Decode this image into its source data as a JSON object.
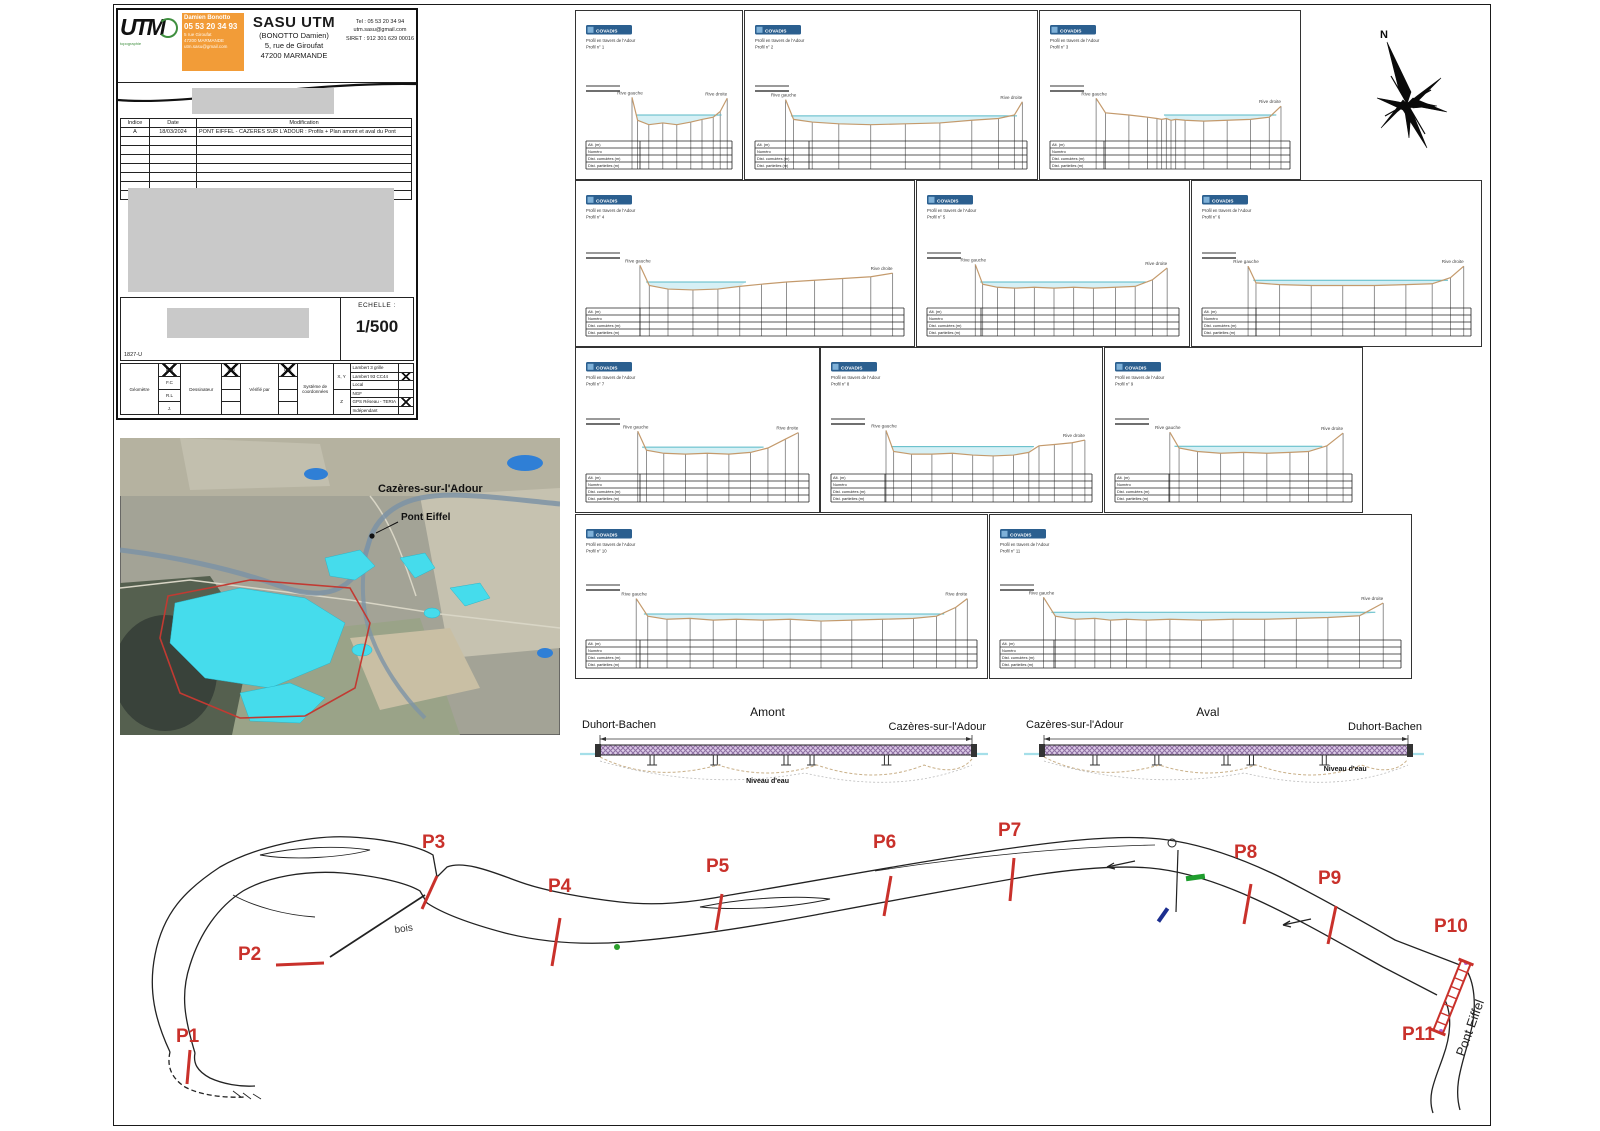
{
  "sheet": {
    "ref": "1827-U",
    "scale_label": "ECHELLE :",
    "scale_value": "1/500",
    "north_label": "N"
  },
  "title_block": {
    "logo_text": "UTM",
    "logo_sub": "topographie",
    "card": {
      "name": "Damien Bonotto",
      "phone": "05 53 20 34 93",
      "line1": "5 rue Giroufat",
      "line2": "47200 MARMANDE",
      "line3": "utm.sasu@gmail.com"
    },
    "company": "SASU UTM",
    "company_sub": "(BONOTTO Damien)",
    "address1": "5, rue de Giroufat",
    "address2": "47200 MARMANDE",
    "tel": "Tel : 05 53 20 34 94",
    "email": "utm.sasu@gmail.com",
    "siret": "SIRET : 912 301 629 00016",
    "revisions": {
      "headers": [
        "Indice",
        "Date",
        "Modification"
      ],
      "rows": [
        [
          "A",
          "18/03/2024",
          "PONT EIFFEL - CAZERES SUR L'ADOUR : Profils + Plan amont et aval du Pont"
        ]
      ],
      "empty_row_count": 7
    }
  },
  "survey_box": {
    "geom_label": "Géomètre",
    "geom_initials": [
      "D.B",
      "F.C",
      "R.L",
      "J."
    ],
    "drafter_label": "Dessinateur",
    "drafter_initial": "D.B",
    "checker_label": "Vérifié par",
    "checker_initial": "D.B",
    "coord_label": "Système de coordonnées",
    "xy_label": "X, Y",
    "z_label": "Z",
    "systems": [
      "Lambert 3 grille",
      "Lambert 93 CC44",
      "Local",
      "NGF",
      "GPS Réseau - TERIA",
      "Indépendant"
    ],
    "checked_systems": [
      1,
      4
    ]
  },
  "map": {
    "town_label": "Cazères-sur-l'Adour",
    "bridge_label": "Pont Eiffel"
  },
  "profiles": {
    "badge": "COVADIS",
    "subtitle": "Profil en travers de l'Adour",
    "left_bank": "Rive gauche",
    "right_bank": "Rive droite",
    "table_rows": [
      "Alt. (m)",
      "Numéro",
      "Dist. cumulées (m)",
      "Dist. partielles (m)"
    ],
    "colors": {
      "terrain": "#c49a6c",
      "water_fill": "#d4eff4",
      "water_line": "#58b9c6",
      "ordinate": "#767676"
    },
    "panels": [
      {
        "id": "P1",
        "label": "Profil n° 1",
        "rect": [
          575,
          10,
          166,
          168
        ],
        "terrain": [
          [
            0.3,
            0.1
          ],
          [
            0.34,
            0.62
          ],
          [
            0.42,
            0.72
          ],
          [
            0.52,
            0.68
          ],
          [
            0.62,
            0.72
          ],
          [
            0.72,
            0.66
          ],
          [
            0.8,
            0.6
          ],
          [
            0.88,
            0.55
          ],
          [
            0.93,
            0.42
          ],
          [
            0.98,
            0.12
          ]
        ],
        "water": {
          "span": [
            0.33,
            0.94
          ],
          "level": 0.5
        }
      },
      {
        "id": "P2",
        "label": "Profil n° 2",
        "rect": [
          744,
          10,
          292,
          168
        ],
        "terrain": [
          [
            0.1,
            0.15
          ],
          [
            0.13,
            0.6
          ],
          [
            0.2,
            0.66
          ],
          [
            0.3,
            0.7
          ],
          [
            0.42,
            0.72
          ],
          [
            0.55,
            0.7
          ],
          [
            0.68,
            0.68
          ],
          [
            0.8,
            0.62
          ],
          [
            0.9,
            0.58
          ],
          [
            0.96,
            0.5
          ],
          [
            0.99,
            0.2
          ]
        ],
        "water": {
          "span": [
            0.12,
            0.97
          ],
          "level": 0.52
        }
      },
      {
        "id": "P3",
        "label": "Profil n° 3",
        "rect": [
          1039,
          10,
          260,
          168
        ],
        "terrain": [
          [
            0.18,
            0.12
          ],
          [
            0.22,
            0.45
          ],
          [
            0.32,
            0.5
          ],
          [
            0.4,
            0.55
          ],
          [
            0.44,
            0.58
          ],
          [
            0.46,
            0.6
          ],
          [
            0.48,
            0.58
          ],
          [
            0.5,
            0.62
          ],
          [
            0.52,
            0.6
          ],
          [
            0.56,
            0.62
          ],
          [
            0.64,
            0.64
          ],
          [
            0.74,
            0.62
          ],
          [
            0.84,
            0.6
          ],
          [
            0.92,
            0.55
          ],
          [
            0.97,
            0.3
          ]
        ],
        "water": {
          "span": [
            0.47,
            0.95
          ],
          "level": 0.5
        }
      },
      {
        "id": "P4",
        "label": "Profil n° 4",
        "rect": [
          575,
          180,
          338,
          165
        ],
        "terrain": [
          [
            0.16,
            0.12
          ],
          [
            0.19,
            0.58
          ],
          [
            0.25,
            0.66
          ],
          [
            0.33,
            0.68
          ],
          [
            0.41,
            0.66
          ],
          [
            0.48,
            0.6
          ],
          [
            0.55,
            0.55
          ],
          [
            0.63,
            0.5
          ],
          [
            0.72,
            0.46
          ],
          [
            0.81,
            0.42
          ],
          [
            0.9,
            0.38
          ],
          [
            0.97,
            0.3
          ]
        ],
        "water": {
          "span": [
            0.18,
            0.5
          ],
          "level": 0.5
        }
      },
      {
        "id": "P5",
        "label": "Profil n° 5",
        "rect": [
          916,
          180,
          272,
          165
        ],
        "terrain": [
          [
            0.18,
            0.1
          ],
          [
            0.21,
            0.55
          ],
          [
            0.27,
            0.62
          ],
          [
            0.34,
            0.64
          ],
          [
            0.42,
            0.62
          ],
          [
            0.5,
            0.64
          ],
          [
            0.58,
            0.62
          ],
          [
            0.66,
            0.64
          ],
          [
            0.75,
            0.62
          ],
          [
            0.83,
            0.6
          ],
          [
            0.9,
            0.45
          ],
          [
            0.96,
            0.18
          ]
        ],
        "water": {
          "span": [
            0.2,
            0.88
          ],
          "level": 0.5
        }
      },
      {
        "id": "P6",
        "label": "Profil n° 6",
        "rect": [
          1191,
          180,
          289,
          165
        ],
        "terrain": [
          [
            0.16,
            0.14
          ],
          [
            0.19,
            0.52
          ],
          [
            0.28,
            0.56
          ],
          [
            0.4,
            0.58
          ],
          [
            0.52,
            0.58
          ],
          [
            0.64,
            0.58
          ],
          [
            0.76,
            0.56
          ],
          [
            0.86,
            0.54
          ],
          [
            0.93,
            0.4
          ],
          [
            0.98,
            0.14
          ]
        ],
        "water": {
          "span": [
            0.18,
            0.92
          ],
          "level": 0.46
        }
      },
      {
        "id": "P7",
        "label": "Profil n° 7",
        "rect": [
          575,
          347,
          243,
          164
        ],
        "terrain": [
          [
            0.22,
            0.12
          ],
          [
            0.26,
            0.55
          ],
          [
            0.34,
            0.62
          ],
          [
            0.44,
            0.64
          ],
          [
            0.54,
            0.62
          ],
          [
            0.64,
            0.64
          ],
          [
            0.74,
            0.6
          ],
          [
            0.82,
            0.5
          ],
          [
            0.9,
            0.3
          ],
          [
            0.96,
            0.15
          ]
        ],
        "water": {
          "span": [
            0.24,
            0.8
          ],
          "level": 0.48
        }
      },
      {
        "id": "P8",
        "label": "Profil n° 8",
        "rect": [
          820,
          347,
          281,
          164
        ],
        "terrain": [
          [
            0.2,
            0.1
          ],
          [
            0.23,
            0.58
          ],
          [
            0.3,
            0.64
          ],
          [
            0.38,
            0.64
          ],
          [
            0.46,
            0.62
          ],
          [
            0.54,
            0.66
          ],
          [
            0.62,
            0.68
          ],
          [
            0.7,
            0.66
          ],
          [
            0.76,
            0.6
          ],
          [
            0.8,
            0.45
          ],
          [
            0.86,
            0.42
          ],
          [
            0.93,
            0.38
          ],
          [
            0.98,
            0.32
          ]
        ],
        "water": {
          "span": [
            0.22,
            0.78
          ],
          "level": 0.47
        }
      },
      {
        "id": "P9",
        "label": "Profil n° 9",
        "rect": [
          1104,
          347,
          257,
          164
        ],
        "terrain": [
          [
            0.22,
            0.14
          ],
          [
            0.26,
            0.5
          ],
          [
            0.34,
            0.58
          ],
          [
            0.44,
            0.62
          ],
          [
            0.54,
            0.6
          ],
          [
            0.64,
            0.62
          ],
          [
            0.74,
            0.6
          ],
          [
            0.82,
            0.58
          ],
          [
            0.9,
            0.45
          ],
          [
            0.97,
            0.16
          ]
        ],
        "water": {
          "span": [
            0.24,
            0.88
          ],
          "level": 0.46
        }
      },
      {
        "id": "P10",
        "label": "Profil n° 10",
        "rect": [
          575,
          514,
          411,
          163
        ],
        "terrain": [
          [
            0.12,
            0.15
          ],
          [
            0.15,
            0.55
          ],
          [
            0.2,
            0.62
          ],
          [
            0.26,
            0.6
          ],
          [
            0.32,
            0.64
          ],
          [
            0.38,
            0.62
          ],
          [
            0.45,
            0.64
          ],
          [
            0.52,
            0.62
          ],
          [
            0.6,
            0.66
          ],
          [
            0.68,
            0.64
          ],
          [
            0.76,
            0.62
          ],
          [
            0.84,
            0.6
          ],
          [
            0.9,
            0.55
          ],
          [
            0.95,
            0.35
          ],
          [
            0.98,
            0.15
          ]
        ],
        "water": {
          "span": [
            0.14,
            0.92
          ],
          "level": 0.5
        }
      },
      {
        "id": "P11",
        "label": "Profil n° 11",
        "rect": [
          989,
          514,
          421,
          163
        ],
        "terrain": [
          [
            0.1,
            0.12
          ],
          [
            0.13,
            0.55
          ],
          [
            0.18,
            0.62
          ],
          [
            0.23,
            0.6
          ],
          [
            0.27,
            0.64
          ],
          [
            0.31,
            0.62
          ],
          [
            0.36,
            0.64
          ],
          [
            0.42,
            0.62
          ],
          [
            0.5,
            0.64
          ],
          [
            0.58,
            0.62
          ],
          [
            0.66,
            0.62
          ],
          [
            0.74,
            0.6
          ],
          [
            0.82,
            0.58
          ],
          [
            0.9,
            0.54
          ],
          [
            0.96,
            0.25
          ]
        ],
        "water": {
          "span": [
            0.12,
            0.94
          ],
          "level": 0.46
        }
      }
    ]
  },
  "elevations": {
    "water_label": "Niveau d'eau",
    "items": [
      {
        "title": "Amont",
        "left": "Duhort-Bachen",
        "right": "Cazères-sur-l'Adour",
        "rect": [
          578,
          703,
          412,
          92
        ],
        "water_label_pos": [
          0.46,
          80
        ]
      },
      {
        "title": "Aval",
        "left": "Cazères-sur-l'Adour",
        "right": "Duhort-Bachen",
        "rect": [
          1022,
          703,
          404,
          92
        ],
        "water_label_pos": [
          0.8,
          68
        ]
      }
    ]
  },
  "plan": {
    "marker_color": "#c9312b",
    "bois_label": "bois",
    "bridge_label": "Pont Eiffel",
    "markers": [
      {
        "id": "P1",
        "label_x": 176,
        "label_y": 1026,
        "tick": [
          190,
          1050,
          187,
          1084
        ]
      },
      {
        "id": "P2",
        "label_x": 238,
        "label_y": 944,
        "tick": [
          276,
          965,
          324,
          963
        ]
      },
      {
        "id": "P3",
        "label_x": 422,
        "label_y": 832,
        "tick": [
          437,
          876,
          422,
          909
        ]
      },
      {
        "id": "P4",
        "label_x": 548,
        "label_y": 876,
        "tick": [
          560,
          918,
          552,
          966
        ]
      },
      {
        "id": "P5",
        "label_x": 706,
        "label_y": 856,
        "tick": [
          722,
          894,
          716,
          930
        ]
      },
      {
        "id": "P6",
        "label_x": 873,
        "label_y": 832,
        "tick": [
          891,
          876,
          884,
          916
        ]
      },
      {
        "id": "P7",
        "label_x": 998,
        "label_y": 820,
        "tick": [
          1014,
          858,
          1010,
          901
        ]
      },
      {
        "id": "P8",
        "label_x": 1234,
        "label_y": 842,
        "tick": [
          1251,
          884,
          1244,
          924
        ]
      },
      {
        "id": "P9",
        "label_x": 1318,
        "label_y": 868,
        "tick": [
          1336,
          906,
          1328,
          944
        ]
      },
      {
        "id": "P10",
        "label_x": 1434,
        "label_y": 916,
        "tick": null
      },
      {
        "id": "P11",
        "label_x": 1402,
        "label_y": 1024,
        "tick": null
      }
    ],
    "bridge_band": [
      1466,
      962,
      1438,
      1032
    ]
  }
}
